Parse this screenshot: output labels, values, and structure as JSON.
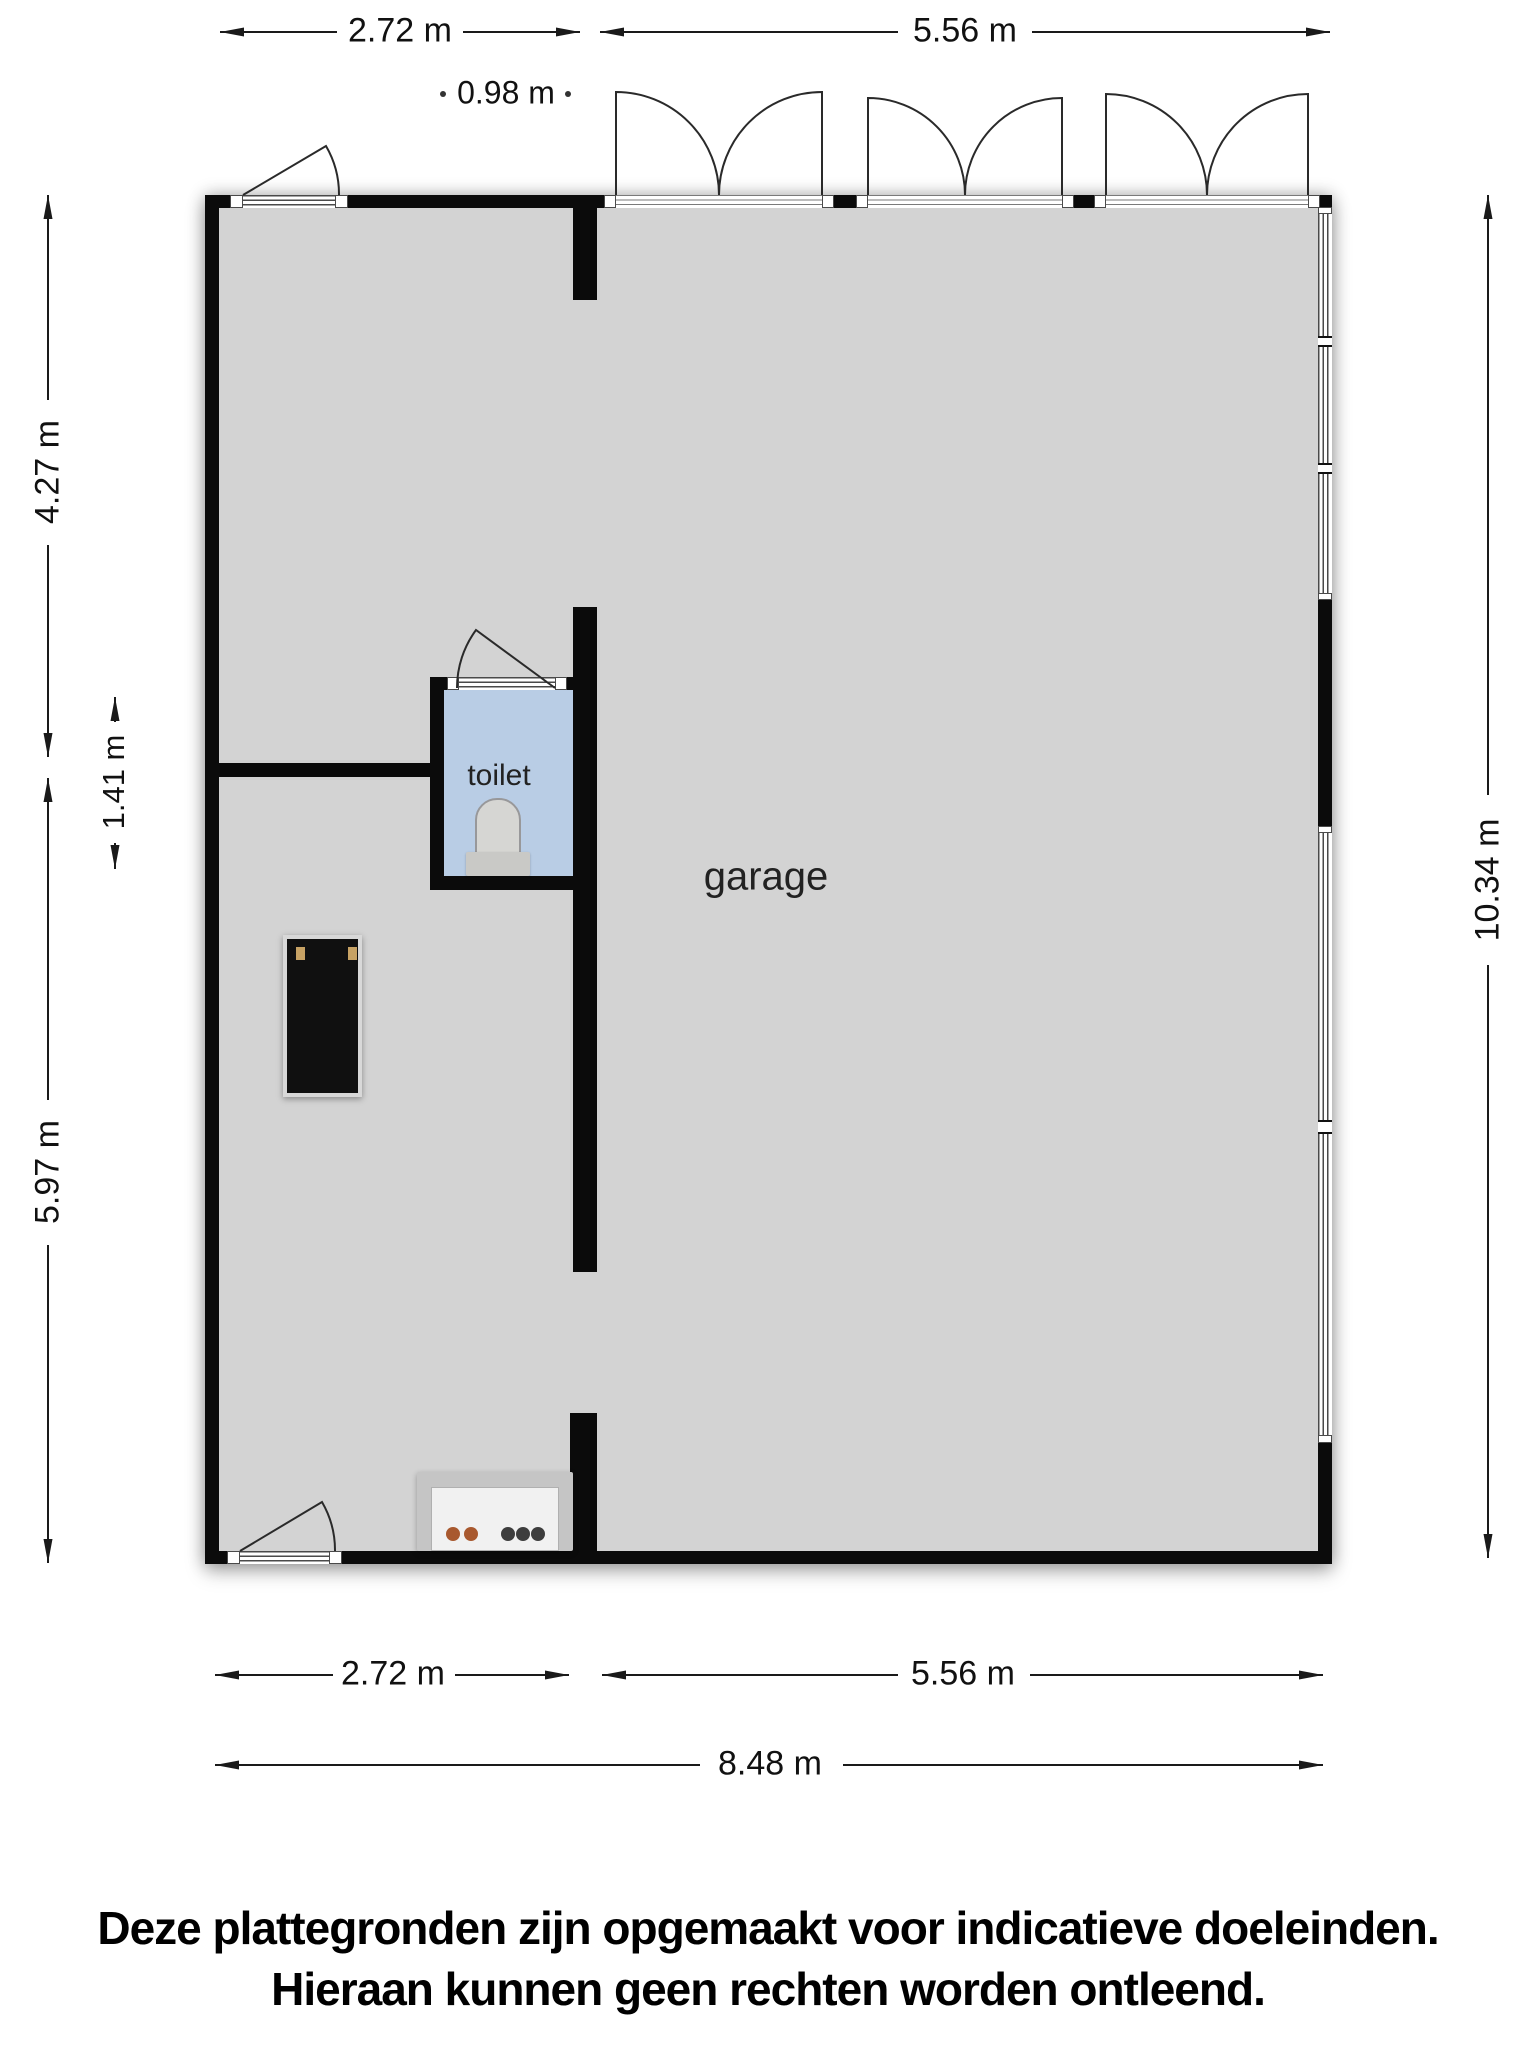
{
  "plan": {
    "room_labels": {
      "garage": "garage",
      "toilet": "toilet"
    },
    "colors": {
      "wall": "#0b0b0b",
      "garage_floor": "#d3d3d3",
      "toilet_floor": "#b9cde5",
      "dimension_text": "#1a1a1a",
      "stove_knob_orange": "#a8582e",
      "stove_knob_dark": "#3d3d3d",
      "cabinet_handle_tan": "#c7a264"
    }
  },
  "dimensions": {
    "top_left": "2.72 m",
    "top_right": "5.56 m",
    "top_inset": "0.98 m",
    "left_upper": "4.27 m",
    "left_toilet": "1.41 m",
    "left_lower": "5.97 m",
    "right_total": "10.34 m",
    "bottom_left": "2.72 m",
    "bottom_right": "5.56 m",
    "bottom_total": "8.48 m"
  },
  "footer": {
    "line1": "Deze plattegronden zijn opgemaakt voor indicatieve doeleinden.",
    "line2": "Hieraan kunnen geen rechten worden ontleend."
  }
}
